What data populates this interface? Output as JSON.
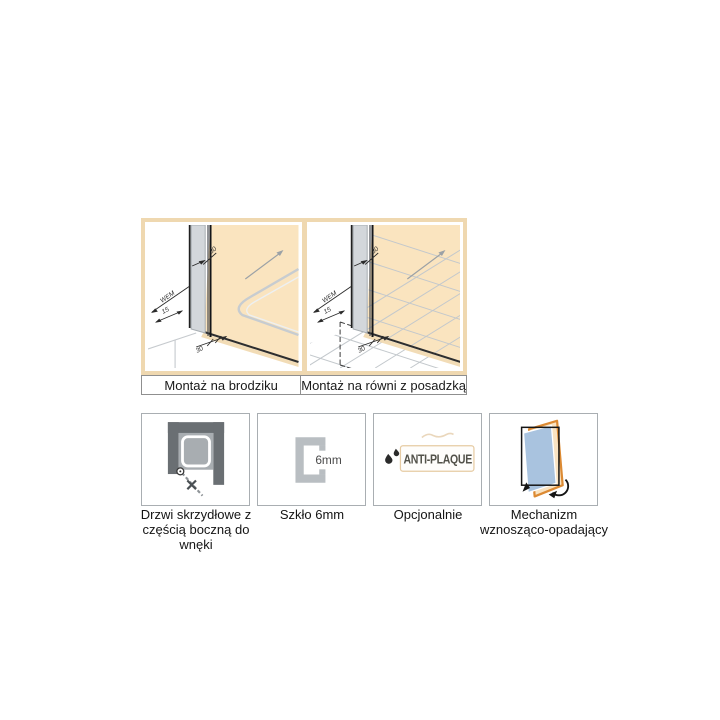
{
  "diagrams": {
    "captions": [
      "Montaż na brodziku",
      "Montaż na równi z posadzką"
    ],
    "dims": {
      "glass_thickness_top": "30",
      "wall_mount": "WEM",
      "profile_depth": "15",
      "floor_clearance": "30"
    },
    "colors": {
      "panel_bg": "#FAE4BF",
      "frame": "#EFD8B0",
      "wall_gray": "#D3D7DB",
      "line_dark": "#1f1f1f",
      "line_gray": "#C6CACE"
    }
  },
  "features": [
    {
      "label": "Drzwi skrzydłowe z częścią boczną do wnęki",
      "icon": "hinged-door-plan-icon"
    },
    {
      "label": "Szkło 6mm",
      "icon": "glass-profile-icon",
      "icon_text": "6mm"
    },
    {
      "label": "Opcjonalnie",
      "icon": "anti-plaque-logo-icon",
      "icon_text": "ANTI-PLAQUE"
    },
    {
      "label": "Mechanizm wznosząco-opadający",
      "icon": "rise-fall-door-icon",
      "icon_colors": {
        "frame_orange": "#DC8A33",
        "glass_blue": "#A9C3DF"
      }
    }
  ]
}
